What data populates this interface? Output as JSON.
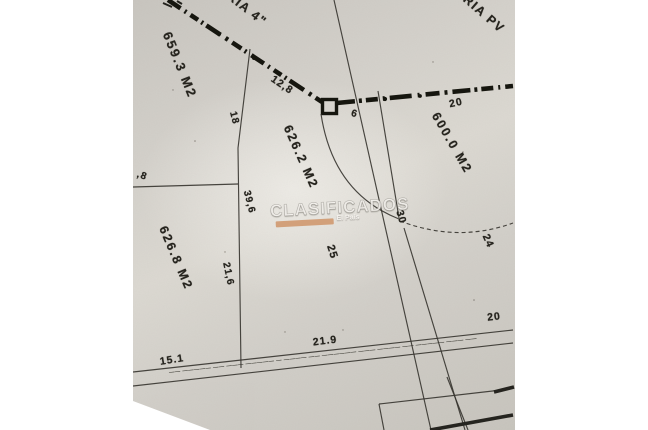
{
  "canvas": {
    "width": 648,
    "height": 430,
    "background": "#ffffff"
  },
  "photo": {
    "paper_color": "#d4d1cb",
    "line_color": "#35332e",
    "sewer_line_color": "#16160f"
  },
  "watermark": {
    "text": "CLASIFICADOS",
    "subtext": "El País",
    "bar_color": "#cf9468"
  },
  "road_strip": {
    "illegible_text_row": "—— ————— —— ——— ————— — ———— —— —————— ——— ———— —— ————— ——— ——"
  },
  "labels": [
    {
      "name": "street-label-top-left",
      "kind": "street",
      "text": "RIA 4\"",
      "x": 247,
      "y": 9,
      "rot": 38,
      "size": 12.5,
      "ls": 1.5
    },
    {
      "name": "street-label-top-right",
      "kind": "street",
      "text": "RIA PV",
      "x": 484,
      "y": 14,
      "rot": 41,
      "size": 12.5,
      "ls": 1.5
    },
    {
      "name": "area-label-659-3",
      "kind": "area",
      "text": "659.3 M2",
      "x": 180,
      "y": 65,
      "rot": 68,
      "size": 13,
      "ls": 2
    },
    {
      "name": "area-label-626-2",
      "kind": "area",
      "text": "626.2 M2",
      "x": 301,
      "y": 157,
      "rot": 66,
      "size": 12.5,
      "ls": 2
    },
    {
      "name": "area-label-626-8",
      "kind": "area",
      "text": "626.8 M2",
      "x": 176,
      "y": 258,
      "rot": 67,
      "size": 12.5,
      "ls": 2
    },
    {
      "name": "area-label-600-0",
      "kind": "area",
      "text": "600.0 M2",
      "x": 452,
      "y": 143,
      "rot": 60,
      "size": 12.5,
      "ls": 2
    },
    {
      "name": "dim-12-8",
      "kind": "dimension",
      "text": "12,8",
      "x": 282,
      "y": 85,
      "rot": 34,
      "size": 10.5,
      "ls": 1
    },
    {
      "name": "dim-18",
      "kind": "dimension",
      "text": "18",
      "x": 234,
      "y": 118,
      "rot": 76,
      "size": 10,
      "ls": 1
    },
    {
      "name": "dim-8-cut",
      "kind": "dimension",
      "text": ",8",
      "x": 142,
      "y": 176,
      "rot": 20,
      "size": 10,
      "ls": 1
    },
    {
      "name": "dim-39-6",
      "kind": "dimension",
      "text": "39,6",
      "x": 249,
      "y": 202,
      "rot": 76,
      "size": 10,
      "ls": 1
    },
    {
      "name": "dim-21-6",
      "kind": "dimension",
      "text": "21,6",
      "x": 228,
      "y": 274,
      "rot": 78,
      "size": 10,
      "ls": 1
    },
    {
      "name": "dim-25",
      "kind": "dimension",
      "text": "25",
      "x": 332,
      "y": 252,
      "rot": 72,
      "size": 11,
      "ls": 1
    },
    {
      "name": "dim-6",
      "kind": "dimension",
      "text": "6",
      "x": 354,
      "y": 114,
      "rot": 15,
      "size": 10,
      "ls": 0
    },
    {
      "name": "dim-20-top",
      "kind": "dimension",
      "text": "20",
      "x": 456,
      "y": 103,
      "rot": -12,
      "size": 10.5,
      "ls": 1
    },
    {
      "name": "dim-30",
      "kind": "dimension",
      "text": "30",
      "x": 401,
      "y": 217,
      "rot": 74,
      "size": 10.5,
      "ls": 1
    },
    {
      "name": "dim-24",
      "kind": "dimension",
      "text": "24",
      "x": 488,
      "y": 241,
      "rot": 66,
      "size": 10.5,
      "ls": 1
    },
    {
      "name": "dim-21-9",
      "kind": "dimension",
      "text": "21.9",
      "x": 325,
      "y": 341,
      "rot": -7,
      "size": 10.5,
      "ls": 1
    },
    {
      "name": "dim-15-1",
      "kind": "dimension",
      "text": "15.1",
      "x": 172,
      "y": 360,
      "rot": -9,
      "size": 10.5,
      "ls": 1
    },
    {
      "name": "dim-20-road",
      "kind": "dimension",
      "text": "20",
      "x": 494,
      "y": 317,
      "rot": -7,
      "size": 10.5,
      "ls": 1
    }
  ]
}
